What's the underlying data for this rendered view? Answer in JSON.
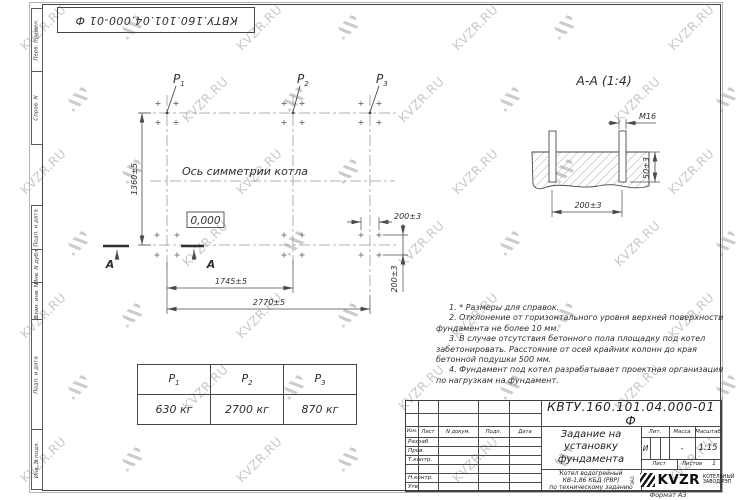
{
  "watermark": {
    "text": "KVZR.RU"
  },
  "frame": {
    "format_label": "Формат А3"
  },
  "top_stamp": {
    "doc_number": "КВТУ.160.101.04.000-01 Ф"
  },
  "side_strip": {
    "labels": [
      "Перв. примен.",
      "Справ. N",
      "Подп. и дата",
      "Инв. N дубл.",
      "Взам. инв. N",
      "Подп. и дата",
      "Инв. N подл."
    ]
  },
  "plan": {
    "symmetry_axis_label": "Ось симметрии котла",
    "level_mark": "0,000",
    "section_mark": "А",
    "labels": {
      "p1": {
        "base": "P",
        "sub": "1"
      },
      "p2": {
        "base": "P",
        "sub": "2"
      },
      "p3": {
        "base": "P",
        "sub": "3"
      }
    },
    "dimensions": {
      "height": "1360±5",
      "inner_width": "1745±5",
      "outer_width": "2770±5",
      "bolt_spacing_h": "200±3",
      "bolt_spacing_v": "200±3"
    }
  },
  "section_view": {
    "title": "А-А (1:4)",
    "dimensions": {
      "thread": "М16",
      "bolt_spacing": "200±3",
      "embed_depth": "50±3"
    }
  },
  "notes": [
    "1. * Размеры для справок.",
    "2. Отклонение от горизонтального уровня верхней поверхности фундамента не более 10 мм.",
    "3. В случае отсутствия бетонного пола площадку под котел забетонировать. Расстояние от осей крайних колонн до края бетонной подушки 500 мм.",
    "4. Фундамент под котел разрабатывает проектная организация по нагрузкам на фундамент."
  ],
  "load_table": {
    "headers": [
      {
        "base": "P",
        "sub": "1"
      },
      {
        "base": "P",
        "sub": "2"
      },
      {
        "base": "P",
        "sub": "3"
      }
    ],
    "values": [
      "630 кг",
      "2700 кг",
      "870 кг"
    ]
  },
  "title_block": {
    "doc_number": "КВТУ.160.101.04.000-01 Ф",
    "title_lines": [
      "Задание на",
      "установку",
      "фундамента"
    ],
    "subtitle_lines": [
      "Котел водогрейный",
      "КВ-1,86 КБД (РВР)",
      "по техническому заданию"
    ],
    "header_cells": [
      "Изм.",
      "Лист",
      "N докум.",
      "Подп.",
      "Дата"
    ],
    "row_labels": [
      "Разраб.",
      "Пров.",
      "Т.контр.",
      "",
      "Н.контр.",
      "Утв."
    ],
    "lit_label": "Лит.",
    "mass_label": "Масса",
    "scale_label": "Масштаб",
    "lit_value": "И",
    "mass_value": "-",
    "scale_value": "1:15",
    "sheet_label": "Лист",
    "sheets_label": "Листов",
    "sheets_value": "1",
    "logo_prefix": "ЗАО",
    "logo_text": "KVZR",
    "company_line1": "КОТЕЛЬНЫЙ",
    "company_line2": "ЗАВОД РЭП"
  }
}
